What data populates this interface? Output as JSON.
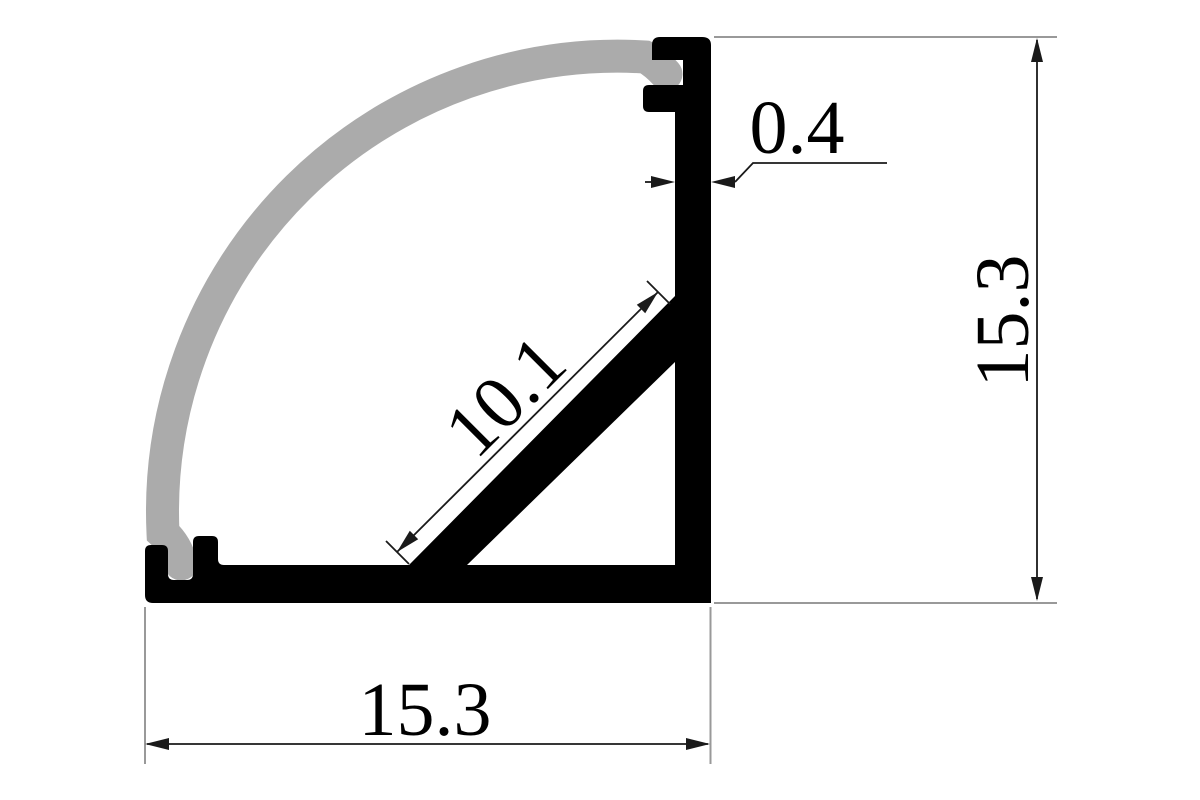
{
  "drawing": {
    "subject": "Corner aluminium LED profile cross-section with curved diffuser",
    "background": "#ffffff",
    "colors": {
      "profile": "#000000",
      "diffuser": "#ababab",
      "dimension_lines": "#1a1a1a",
      "extension_lines": "#999999",
      "text": "#000000"
    },
    "dimensions": {
      "wall_thickness": "0.4",
      "height": "15.3",
      "width": "15.3",
      "diagonal": "10.1"
    }
  }
}
